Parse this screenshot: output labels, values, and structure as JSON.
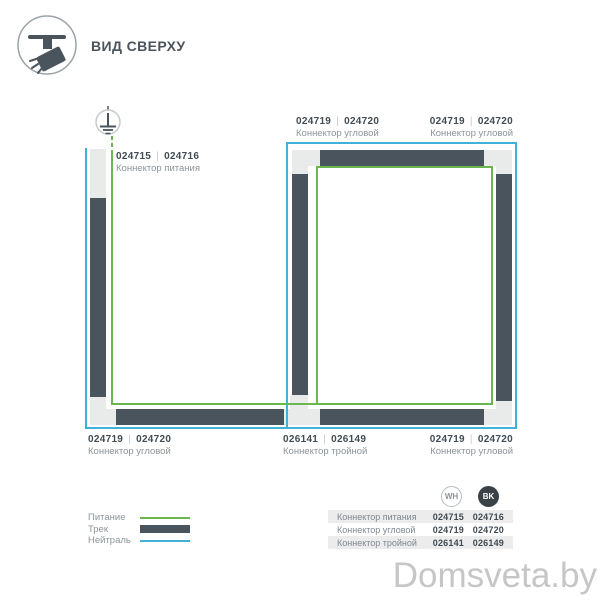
{
  "header": {
    "title": "ВИД СВЕРХУ"
  },
  "ui": {
    "separator": "|"
  },
  "colors": {
    "power_green": "#6ab84d",
    "neutral_blue": "#41b1d6",
    "track_dark": "#4a545c",
    "connector_light": "#e9eaea"
  },
  "diagram": {
    "labels": {
      "power": {
        "codes": [
          "024715",
          "024716"
        ],
        "name": "Коннектор питания"
      },
      "corner_top_left": {
        "codes": [
          "024719",
          "024720"
        ],
        "name": "Коннектор угловой"
      },
      "corner_top_right": {
        "codes": [
          "024719",
          "024720"
        ],
        "name": "Коннектор угловой"
      },
      "corner_bottom_left": {
        "codes": [
          "024719",
          "024720"
        ],
        "name": "Коннектор угловой"
      },
      "triple_bottom_middle": {
        "codes": [
          "026141",
          "026149"
        ],
        "name": "Коннектор тройной"
      },
      "corner_bottom_right": {
        "codes": [
          "024719",
          "024720"
        ],
        "name": "Коннектор угловой"
      }
    }
  },
  "legend": {
    "items": [
      {
        "label": "Питание",
        "swatch": "power-line-green"
      },
      {
        "label": "Трек",
        "swatch": "track-bar-dark"
      },
      {
        "label": "Нейтраль",
        "swatch": "neutral-line-blue"
      }
    ]
  },
  "table": {
    "col_wh": "WH",
    "col_bk": "BK",
    "rows": [
      {
        "name": "Коннектор питания",
        "wh": "024715",
        "bk": "024716"
      },
      {
        "name": "Коннектор угловой",
        "wh": "024719",
        "bk": "024720"
      },
      {
        "name": "Коннектор тройной",
        "wh": "026141",
        "bk": "026149"
      }
    ]
  },
  "watermark": "Domsveta.by"
}
